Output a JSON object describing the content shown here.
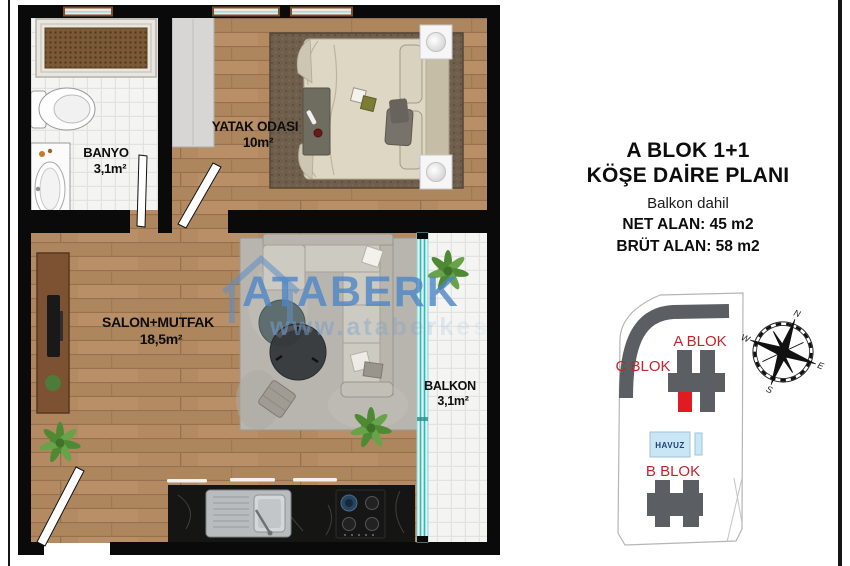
{
  "floorplan": {
    "rooms": {
      "banyo": {
        "name": "BANYO",
        "area": "3,1m²"
      },
      "yatak_odasi": {
        "name": "YATAK ODASI",
        "area": "10m²"
      },
      "salon_mutfak": {
        "name": "SALON+MUTFAK",
        "area": "18,5m²"
      },
      "balkon": {
        "name": "BALKON",
        "area": "3,1m²"
      }
    },
    "watermark": {
      "brand": "ATABERK",
      "url": "www.ataberkes"
    }
  },
  "info_panel": {
    "title_line1": "A BLOK 1+1",
    "title_line2": "KÖŞE DAİRE PLANI",
    "subtitle": "Balkon dahil",
    "net_area": "NET ALAN: 45 m2",
    "brut_area": "BRÜT ALAN: 58 m2"
  },
  "site_plan": {
    "blocks": {
      "a": "A BLOK",
      "b": "B BLOK",
      "c": "C BLOK"
    },
    "pool_label": "HAVUZ",
    "compass": {
      "n": "N",
      "e": "E",
      "s": "S",
      "w": "W"
    }
  },
  "colors": {
    "wall": "#0a0a0a",
    "wood_floor": "#b38a61",
    "tile": "#f4f4f3",
    "glass_teal": "#35b5b5",
    "building_gray": "#5b5e63",
    "highlight_unit_red": "#e01b22",
    "site_label_red": "#c4242b",
    "pool_blue": "#c9e6f4",
    "watermark_blue": "#4d86c6",
    "counter_marble": "#151614"
  }
}
